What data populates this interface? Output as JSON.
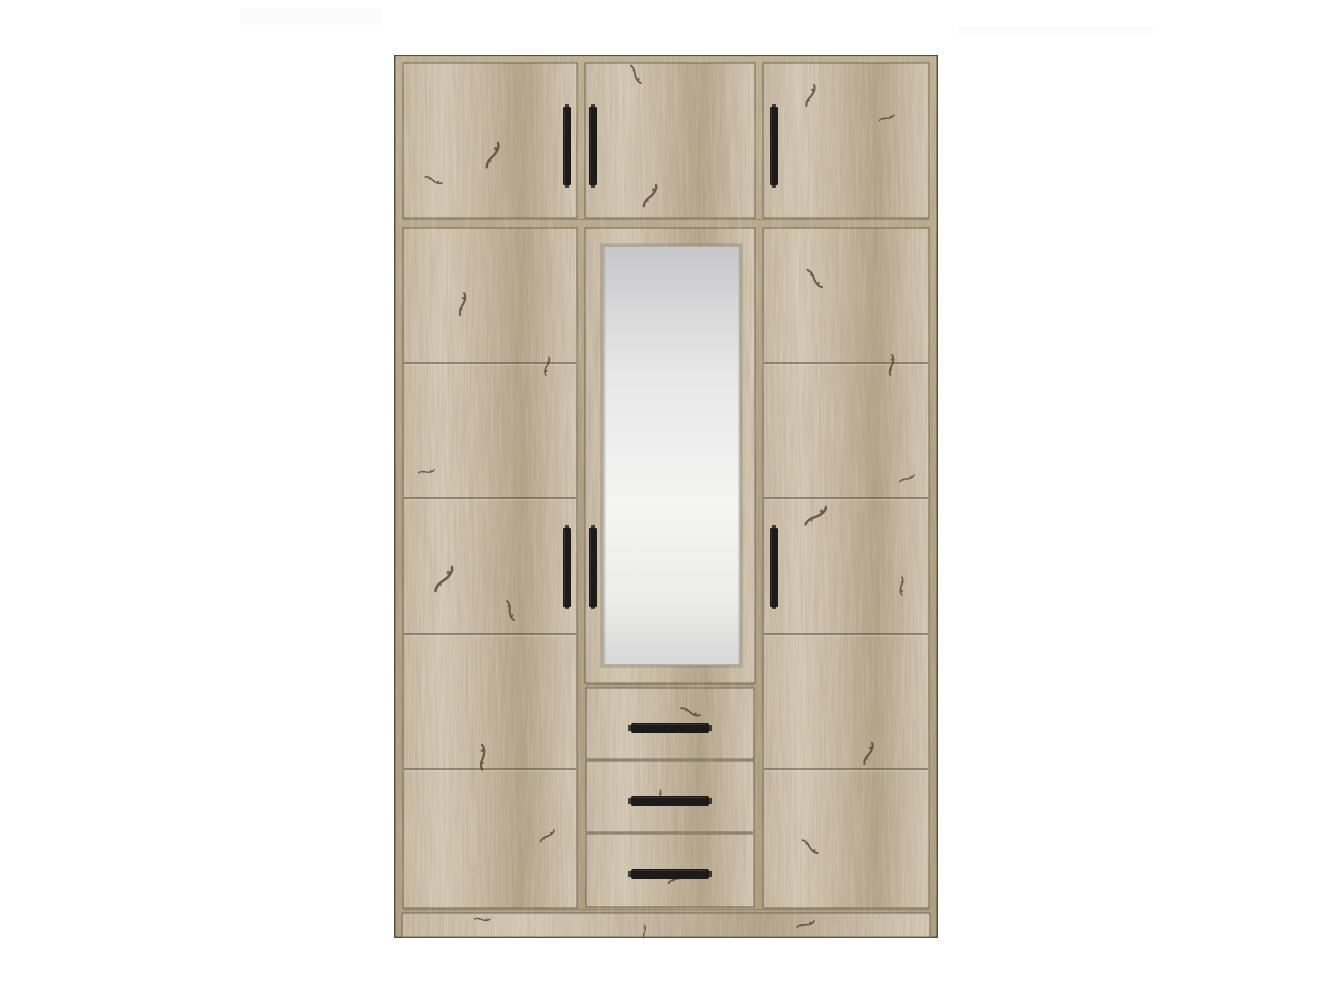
{
  "scene": {
    "background_color": "#ffffff",
    "description": "studio product photo of a tall wardrobe centered on a plain white background"
  },
  "wardrobe": {
    "type": "three-section wardrobe with overhead cabinets, central mirror door and three drawers",
    "finish": "light artisan oak with black bar handles",
    "colors": {
      "wood_base": "#c7b9a2",
      "wood_light": "#d5c9b4",
      "wood_dark": "#b3a48a",
      "wood_frame": "#b0a083",
      "wood_frame_light": "#c0b295",
      "seam_dark": "#554e3c",
      "door_edge": "#6b6352",
      "handle_black": "#1d1b19",
      "handle_sheen": "#4a4845",
      "mirror_top": "#c7c7c9",
      "mirror_upper": "#e7e7e8",
      "mirror_mid": "#f4f4f3",
      "mirror_lower": "#ececeb",
      "mirror_bottom": "#d6d6d6",
      "mirror_edge": "#90897c",
      "knot_brown": "#4a3a29"
    },
    "counts": {
      "sections": 3,
      "top_doors": 3,
      "tall_doors": 2,
      "mirror_doors": 1,
      "drawers": 3,
      "grooves_per_tall_door": 4,
      "handles_total": 9
    }
  }
}
